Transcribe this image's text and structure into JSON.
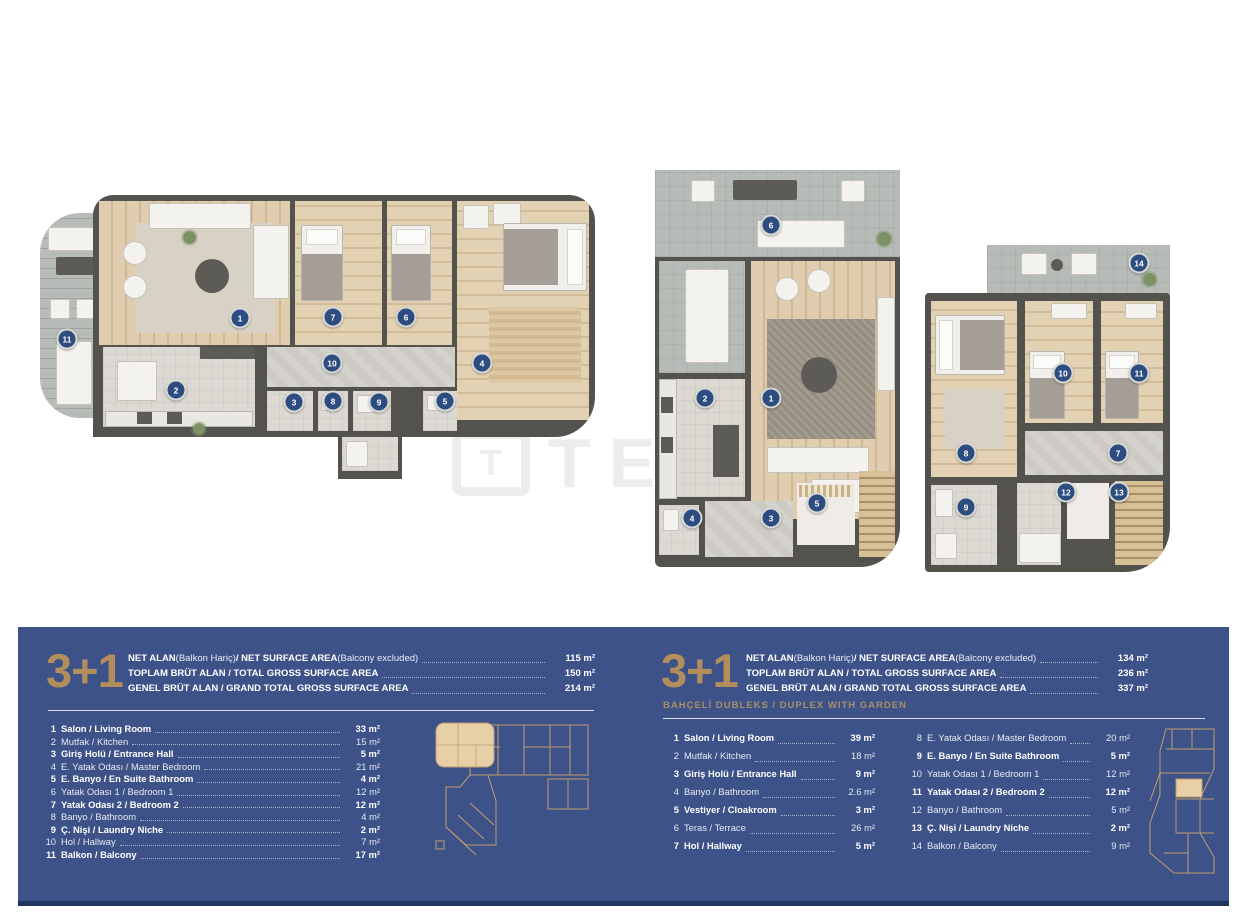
{
  "colors": {
    "panel_bg": "#3d5288",
    "accent_gold": "#b28e5c",
    "subtitle_gold": "#a79066",
    "marker_bg": "#2d4d80",
    "wall": "#53524d",
    "watermark": "#ededed"
  },
  "watermark": {
    "logo_letter": "T",
    "text": "TEKCE"
  },
  "plans": {
    "left": {
      "markers": [
        {
          "label": "11",
          "x": 32,
          "y": 144
        },
        {
          "label": "1",
          "x": 205,
          "y": 123
        },
        {
          "label": "2",
          "x": 141,
          "y": 195
        },
        {
          "label": "7",
          "x": 298,
          "y": 122
        },
        {
          "label": "6",
          "x": 371,
          "y": 122
        },
        {
          "label": "10",
          "x": 297,
          "y": 168
        },
        {
          "label": "3",
          "x": 259,
          "y": 207
        },
        {
          "label": "8",
          "x": 298,
          "y": 206
        },
        {
          "label": "9",
          "x": 344,
          "y": 207
        },
        {
          "label": "5",
          "x": 410,
          "y": 206
        },
        {
          "label": "4",
          "x": 447,
          "y": 168
        }
      ]
    },
    "middle": {
      "markers": [
        {
          "label": "6",
          "x": 116,
          "y": 55
        },
        {
          "label": "2",
          "x": 50,
          "y": 228
        },
        {
          "label": "1",
          "x": 116,
          "y": 228
        },
        {
          "label": "4",
          "x": 37,
          "y": 348
        },
        {
          "label": "3",
          "x": 116,
          "y": 348
        },
        {
          "label": "5",
          "x": 162,
          "y": 333
        }
      ]
    },
    "right": {
      "markers": [
        {
          "label": "14",
          "x": 214,
          "y": 18
        },
        {
          "label": "10",
          "x": 138,
          "y": 128
        },
        {
          "label": "11",
          "x": 214,
          "y": 128
        },
        {
          "label": "8",
          "x": 41,
          "y": 208
        },
        {
          "label": "7",
          "x": 193,
          "y": 208
        },
        {
          "label": "9",
          "x": 41,
          "y": 262
        },
        {
          "label": "12",
          "x": 141,
          "y": 247
        },
        {
          "label": "13",
          "x": 194,
          "y": 247
        }
      ]
    }
  },
  "panel": {
    "left_block": {
      "type_label": "3+1",
      "summary": [
        {
          "segments": [
            {
              "t": "NET ALAN ",
              "b": true
            },
            {
              "t": "(Balkon Hariç) ",
              "b": false
            },
            {
              "t": "/ NET SURFACE AREA ",
              "b": true
            },
            {
              "t": "(Balcony excluded)",
              "b": false
            }
          ],
          "value": "115 m²"
        },
        {
          "segments": [
            {
              "t": "TOPLAM BRÜT ALAN / TOTAL GROSS SURFACE AREA",
              "b": true
            }
          ],
          "value": "150 m²"
        },
        {
          "segments": [
            {
              "t": "GENEL BRÜT ALAN / GRAND TOTAL GROSS SURFACE AREA",
              "b": true
            }
          ],
          "value": "214 m²"
        }
      ],
      "rooms": [
        {
          "no": "1",
          "name": "Salon / Living Room",
          "value": "33 m²",
          "bold": true
        },
        {
          "no": "2",
          "name": "Mutfak / Kitchen",
          "value": "15 m²",
          "bold": false
        },
        {
          "no": "3",
          "name": "Giriş Holü / Entrance Hall",
          "value": "5 m²",
          "bold": true
        },
        {
          "no": "4",
          "name": "E. Yatak Odası / Master Bedroom",
          "value": "21 m²",
          "bold": false
        },
        {
          "no": "5",
          "name": "E. Banyo / En Suite Bathroom",
          "value": "4 m²",
          "bold": true
        },
        {
          "no": "6",
          "name": "Yatak Odası 1 / Bedroom 1",
          "value": "12 m²",
          "bold": false
        },
        {
          "no": "7",
          "name": "Yatak Odası 2 / Bedroom 2",
          "value": "12 m²",
          "bold": true
        },
        {
          "no": "8",
          "name": "Banyo / Bathroom",
          "value": "4 m²",
          "bold": false
        },
        {
          "no": "9",
          "name": "Ç. Nişi / Laundry Niche",
          "value": "2 m²",
          "bold": true
        },
        {
          "no": "10",
          "name": "Hol / Hallway",
          "value": "7 m²",
          "bold": false
        },
        {
          "no": "11",
          "name": "Balkon / Balcony",
          "value": "17 m²",
          "bold": true
        }
      ]
    },
    "right_block": {
      "type_label": "3+1",
      "subtitle": "BAHÇELİ DUBLEKS / DUPLEX WITH GARDEN",
      "summary": [
        {
          "segments": [
            {
              "t": "NET ALAN ",
              "b": true
            },
            {
              "t": "(Balkon Hariç) ",
              "b": false
            },
            {
              "t": "/ NET SURFACE AREA ",
              "b": true
            },
            {
              "t": "(Balcony excluded)",
              "b": false
            }
          ],
          "value": "134 m²"
        },
        {
          "segments": [
            {
              "t": "TOPLAM BRÜT ALAN / TOTAL GROSS SURFACE AREA",
              "b": true
            }
          ],
          "value": "236 m²"
        },
        {
          "segments": [
            {
              "t": "GENEL BRÜT ALAN / GRAND TOTAL GROSS SURFACE AREA",
              "b": true
            }
          ],
          "value": "337 m²"
        }
      ],
      "rooms_col1": [
        {
          "no": "1",
          "name": "Salon / Living Room",
          "value": "39 m²",
          "bold": true
        },
        {
          "no": "2",
          "name": "Mutfak / Kitchen",
          "value": "18 m²",
          "bold": false
        },
        {
          "no": "3",
          "name": "Giriş Holü / Entrance Hall",
          "value": "9 m²",
          "bold": true
        },
        {
          "no": "4",
          "name": "Banyo / Bathroom",
          "value": "2.6 m²",
          "bold": false
        },
        {
          "no": "5",
          "name": "Vestiyer / Cloakroom",
          "value": "3 m²",
          "bold": true
        },
        {
          "no": "6",
          "name": "Teras / Terrace",
          "value": "26 m²",
          "bold": false
        },
        {
          "no": "7",
          "name": "Hol / Hallway",
          "value": "5 m²",
          "bold": true
        }
      ],
      "rooms_col2": [
        {
          "no": "8",
          "name": "E. Yatak Odası / Master Bedroom",
          "value": "20 m²",
          "bold": false
        },
        {
          "no": "9",
          "name": "E. Banyo / En Suite Bathroom",
          "value": "5 m²",
          "bold": true
        },
        {
          "no": "10",
          "name": "Yatak Odası 1 / Bedroom 1",
          "value": "12 m²",
          "bold": false
        },
        {
          "no": "11",
          "name": "Yatak Odası 2 / Bedroom 2",
          "value": "12 m²",
          "bold": true
        },
        {
          "no": "12",
          "name": "Banyo / Bathroom",
          "value": "5 m²",
          "bold": false
        },
        {
          "no": "13",
          "name": "Ç. Nişi / Laundry Niche",
          "value": "2 m²",
          "bold": true
        },
        {
          "no": "14",
          "name": "Balkon / Balcony",
          "value": "9 m²",
          "bold": false
        }
      ]
    }
  }
}
